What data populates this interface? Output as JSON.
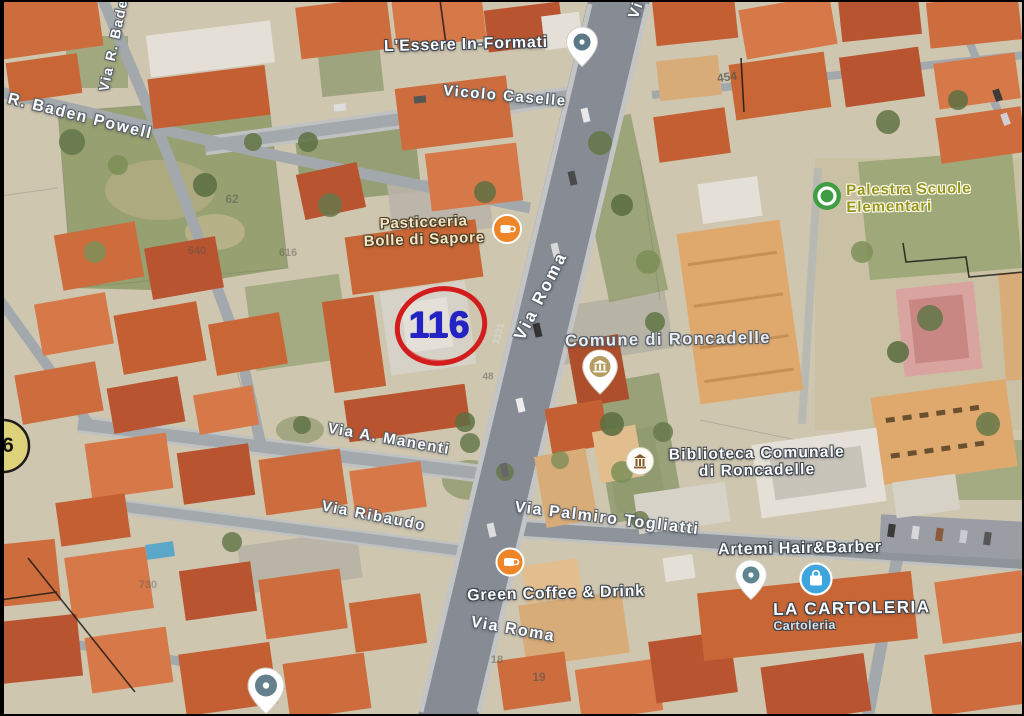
{
  "map": {
    "annotation": {
      "parcel_number": "116",
      "edge_badge": "6"
    },
    "streets": {
      "via_r_baden": "Via R. Baden",
      "r_baden_powell": "R. Baden Powell",
      "vicolo_caselle": "Vicolo Caselle",
      "via_roma_upper": "Via Roma",
      "via_partial": "Vi",
      "via_a_manenti": "Via A. Manenti",
      "via_ribaudo": "Via Ribaudo",
      "via_palmiro_togliatti": "Via Palmiro Togliatti",
      "via_roma_lower": "Via Roma"
    },
    "pois": {
      "lessere": {
        "label": "L'Essere In-Formati"
      },
      "pasticceria": {
        "line1": "Pasticceria",
        "line2": "Bolle di Sapore"
      },
      "palestra": {
        "line1": "Palestra Scuole",
        "line2": "Elementari"
      },
      "comune": {
        "label": "Comune di Roncadelle"
      },
      "biblioteca": {
        "line1": "Biblioteca Comunale",
        "line2": "di Roncadelle"
      },
      "artemi": {
        "label": "Artemi Hair&Barber"
      },
      "green_coffee": {
        "label": "Green Coffee & Drink"
      },
      "cartoleria": {
        "name": "LA CARTOLERIA",
        "subtitle": "Cartoleria"
      }
    },
    "building_numbers": {
      "n454": "454",
      "n62": "62",
      "n640": "640",
      "n616": "616",
      "n730": "730",
      "n3331": "3331",
      "n48": "48",
      "n18": "18",
      "n19": "19"
    },
    "colors": {
      "marker_circle": "#d31d1d",
      "marker_text": "#2424c4",
      "badge_fill": "#e6da50",
      "poi_orange": "#ee8629",
      "poi_green": "#3f9e43",
      "poi_blue": "#3ea6dd"
    }
  }
}
